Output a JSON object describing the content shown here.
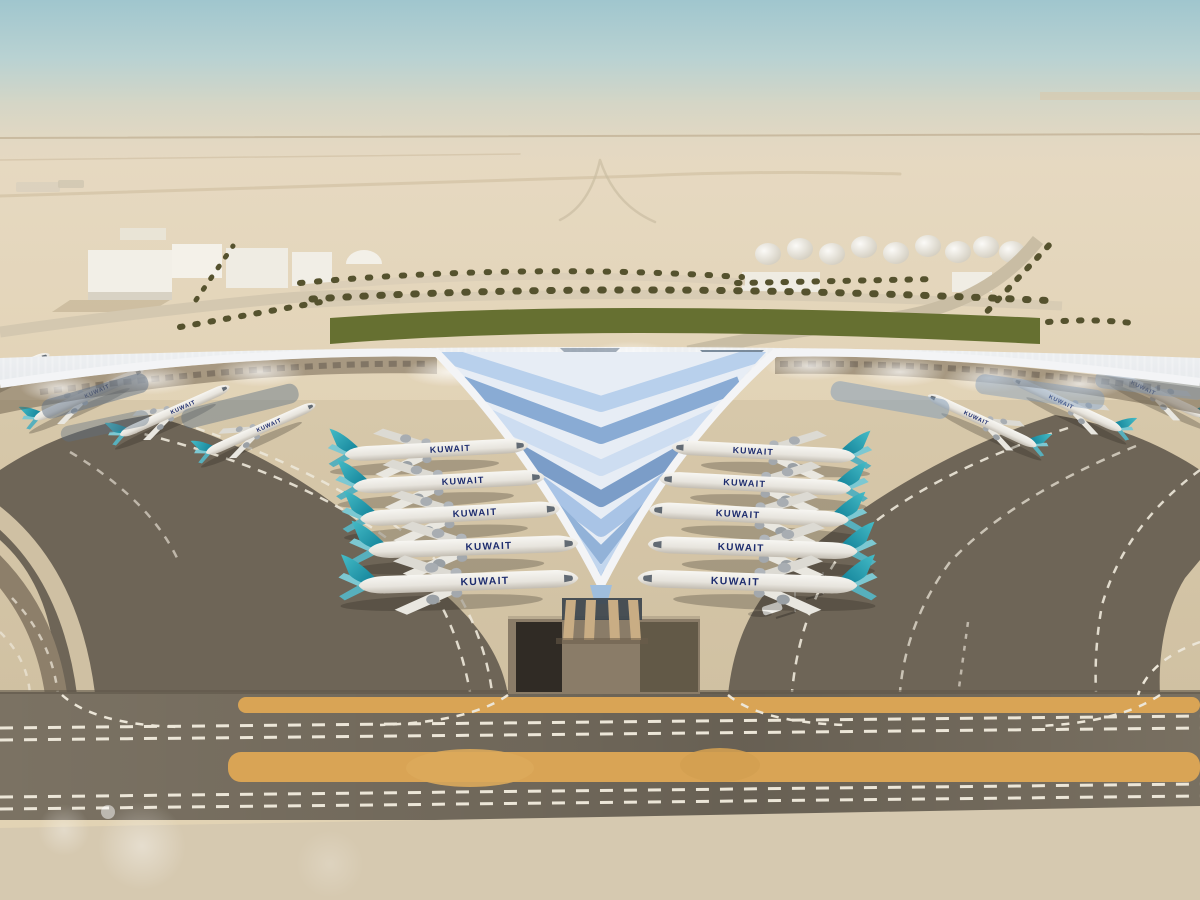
{
  "scene": {
    "description": "Aerial architectural rendering of a winged airport terminal in a desert",
    "airline": "Kuwait Airways",
    "aircraft": {
      "label": "KUWAIT",
      "left_row_count": 5,
      "right_row_count": 5,
      "left_gate_count": 4,
      "right_gate_count": 3,
      "fuselage_color": "#efede7",
      "tail_color": "#1f9fb2",
      "title_color": "#1d2c6e"
    },
    "terminal": {
      "roof_color": "#dde2e6",
      "glass_blue": "#8fb0d8",
      "glass_slate": "#5d7085",
      "column_color": "#c9ad84"
    },
    "ground": {
      "apron_color": "#d6c7a9",
      "taxiway_dark": "#6e6557",
      "band_color": "#7b7263",
      "shoulder_orange": "#d9a455",
      "marking_color": "#ece6d8",
      "sunken_road_color": "#8a7c68"
    },
    "environment": {
      "sky_top": "#a0c6ce",
      "sky_haze": "#e3d7c0",
      "desert": "#e2d3b4",
      "hedge_green": "#667031",
      "fuel_tank_count": 9,
      "warehouse_count": 6,
      "palm_rows": 7,
      "service_vehicle_count": 1,
      "light_pole_count": 2
    }
  }
}
